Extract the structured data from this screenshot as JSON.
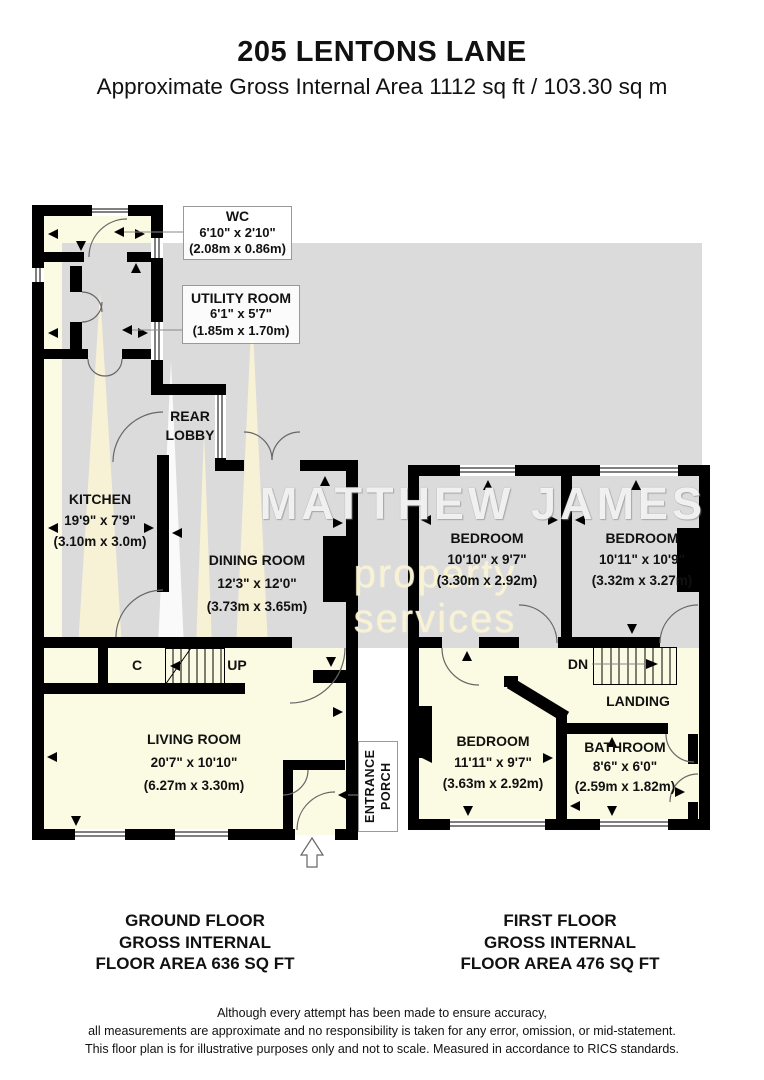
{
  "header": {
    "title": "205 LENTONS LANE",
    "subtitle": "Approximate Gross Internal Area 1112 sq ft / 103.30 sq m"
  },
  "watermark": {
    "line1": "MATTHEW JAMES",
    "line2": "property services"
  },
  "ground_floor": {
    "title_lines": [
      "GROUND FLOOR",
      "GROSS INTERNAL",
      "FLOOR AREA 636 SQ FT"
    ],
    "rooms": [
      {
        "name": "WC",
        "imperial": "6'10\" x 2'10\"",
        "metric": "(2.08m x 0.86m)"
      },
      {
        "name": "UTILITY ROOM",
        "imperial": "6'1\" x 5'7\"",
        "metric": "(1.85m x 1.70m)"
      },
      {
        "name": "REAR LOBBY"
      },
      {
        "name": "KITCHEN",
        "imperial": "19'9\" x 7'9\"",
        "metric": "(3.10m x 3.0m)"
      },
      {
        "name": "DINING ROOM",
        "imperial": "12'3\" x 12'0\"",
        "metric": "(3.73m x 3.65m)"
      },
      {
        "name": "LIVING ROOM",
        "imperial": "20'7\" x 10'10\"",
        "metric": "(6.27m x 3.30m)"
      },
      {
        "name": "ENTRANCE PORCH"
      },
      {
        "name": "C"
      },
      {
        "name": "UP"
      }
    ]
  },
  "first_floor": {
    "title_lines": [
      "FIRST FLOOR",
      "GROSS INTERNAL",
      "FLOOR AREA 476 SQ FT"
    ],
    "rooms": [
      {
        "name": "BEDROOM",
        "imperial": "10'10\" x 9'7\"",
        "metric": "(3.30m x 2.92m)"
      },
      {
        "name": "BEDROOM",
        "imperial": "10'11\" x 10'9\"",
        "metric": "(3.32m x 3.27m)"
      },
      {
        "name": "BEDROOM",
        "imperial": "11'11\" x 9'7\"",
        "metric": "(3.63m x 2.92m)"
      },
      {
        "name": "BATHROOM",
        "imperial": "8'6\" x 6'0\"",
        "metric": "(2.59m x 1.82m)"
      },
      {
        "name": "LANDING"
      },
      {
        "name": "DN"
      }
    ]
  },
  "disclaimer": [
    "Although every attempt has been made to ensure accuracy,",
    "all measurements are approximate and no responsibility is taken for any error, omission, or mid-statement.",
    "This floor plan is for illustrative purposes only and not to scale. Measured in accordance to RICS standards."
  ],
  "colors": {
    "wall": "#000000",
    "floor": "#FBFAE3",
    "band": "#DBDBDB",
    "spire": "#F7F1D5"
  }
}
